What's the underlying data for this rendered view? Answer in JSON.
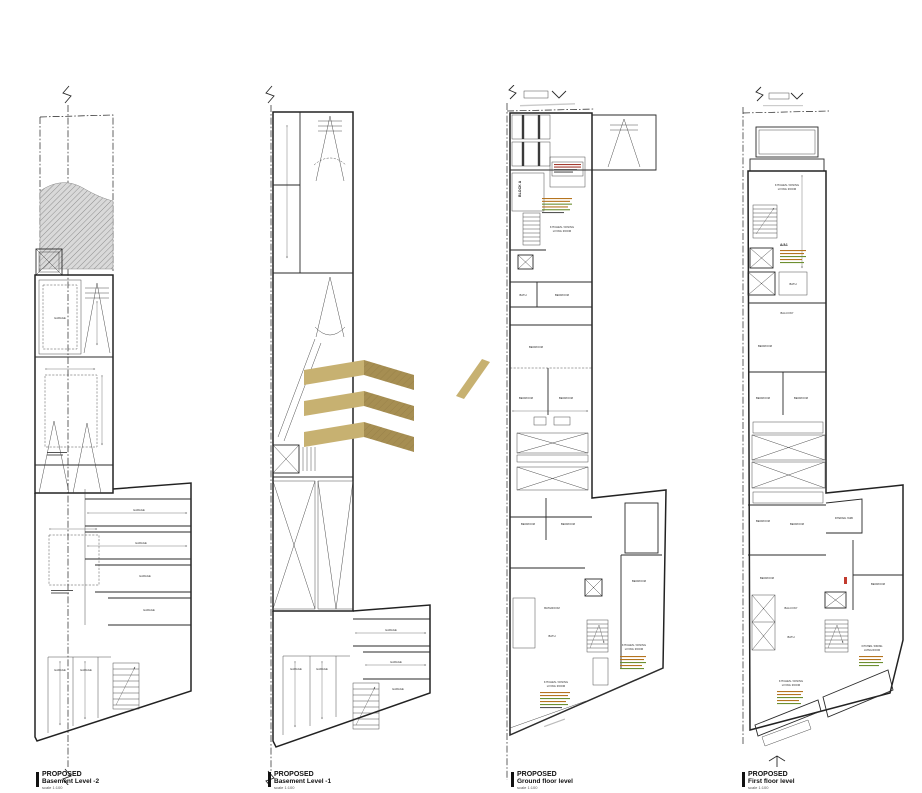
{
  "document": {
    "type": "architectural-floor-plans",
    "background": "#ffffff",
    "line_color": "#222222",
    "watermark_gold_light": "#c7b171",
    "watermark_gold_dark": "#a68e52"
  },
  "labels": {
    "garage": "GARAGE",
    "block_a": "BLOCK A",
    "kitchen": "KITCHEN / DINING",
    "living": "LIVING ROOM",
    "bedroom": "BEDROOM",
    "bathroom": "BATHROOM",
    "bath": "BATH",
    "balcony": "BALCONY",
    "yard": "INTERNAL YARD",
    "aa1": "A/A1"
  },
  "footers": [
    {
      "line1": "PROPOSED",
      "line2": "Basement Level -2",
      "scale": "scale 1:100"
    },
    {
      "line1": "PROPOSED",
      "line2": "Basement Level -1",
      "scale": "scale 1:100"
    },
    {
      "line1": "PROPOSED",
      "line2": "Ground floor level",
      "scale": "scale 1:100"
    },
    {
      "line1": "PROPOSED",
      "line2": "First floor level",
      "scale": "scale 1:100"
    }
  ]
}
